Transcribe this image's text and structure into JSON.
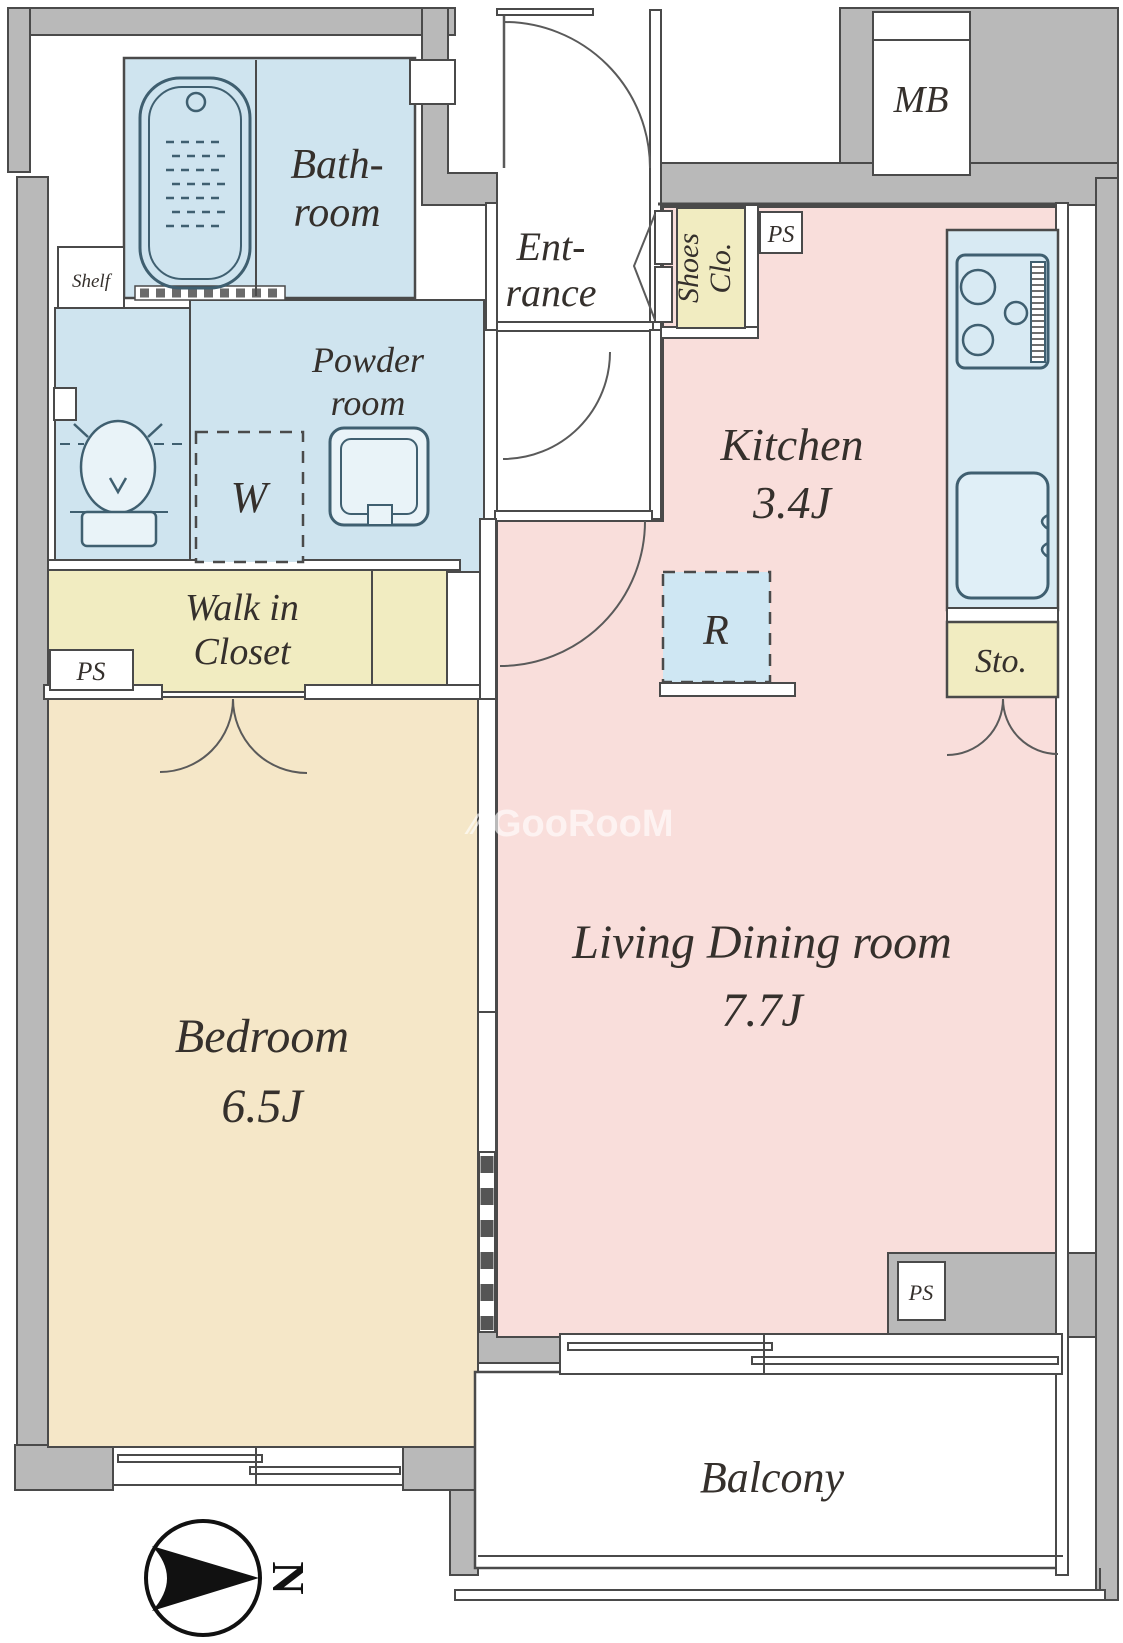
{
  "plan_title": "1LDK apartment floor plan",
  "palette": {
    "wall_gray": "#b9b9b9",
    "outline": "#4a4a4a",
    "water_blue": "#cfe4ef",
    "counter_blue": "#d8eaf3",
    "closet_yellow": "#f1ecc1",
    "room_pink": "#f9dedb",
    "bedroom_beige": "#f5e7c8",
    "label_color": "#35302c",
    "watermark_color": "rgba(255,255,255,0.62)"
  },
  "labels": {
    "bathroom": [
      "Bath-",
      "room"
    ],
    "powder_room": [
      "Powder",
      "room"
    ],
    "walk_in_closet": [
      "Walk in",
      "Closet"
    ],
    "bedroom": [
      "Bedroom",
      "6.5J"
    ],
    "living_dining": [
      "Living Dining room",
      "7.7J"
    ],
    "kitchen": [
      "Kitchen",
      "3.4J"
    ],
    "entrance": [
      "Ent-",
      "rance"
    ],
    "shoes_closet": [
      "Shoes",
      "Clo."
    ],
    "balcony": "Balcony",
    "meter_box": "MB",
    "shelf": "Shelf",
    "washer": "W",
    "refrigerator": "R",
    "storage": "Sto.",
    "pipe_space_top": "PS",
    "pipe_space_closet": "PS",
    "pipe_space_bottom": "PS",
    "north": "N"
  },
  "watermark": {
    "icon": "⁄⁄",
    "text": "GooRooM"
  }
}
